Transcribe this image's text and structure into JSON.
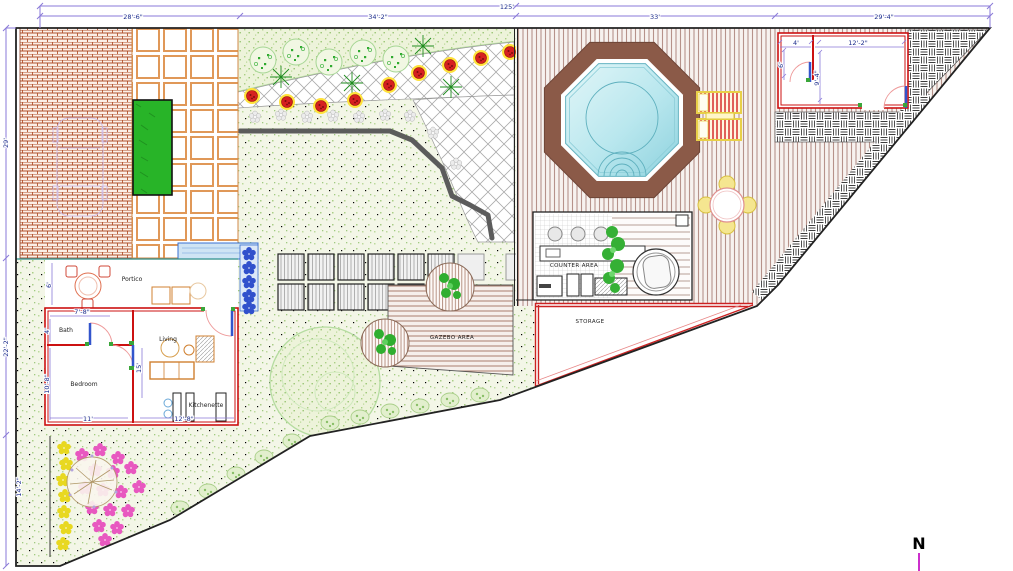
{
  "meta": {
    "north_label": "N"
  },
  "dimensions": {
    "top_total": "125'",
    "top_segments": [
      "28'-6\"",
      "34'-2\"",
      "33'",
      "29'-4\""
    ],
    "left_segments": [
      "29'",
      "22'-2\"",
      "14'-2\""
    ],
    "pool_house": {
      "left_width": "4'",
      "main_width": "12'-2\"",
      "left_depth": "6'",
      "main_depth": "9'-4\""
    },
    "house": {
      "bath_width": "7'-8\"",
      "bath_depth": "4'",
      "portico_depth": "6'",
      "bedroom_depth": "10'-8\"",
      "bedroom_width": "11'",
      "kitchen_width": "12'-8\"",
      "living_depth": "15'"
    }
  },
  "labels": {
    "portico": "Portico",
    "bath": "Bath",
    "bedroom": "Bedroom",
    "living": "Living",
    "kitchenette": "Kitchenette",
    "counter_area": "COUNTER AREA",
    "storage": "STORAGE",
    "gazebo_area": "GAZEBO AREA"
  },
  "colors": {
    "dimension_line": "#8a7ad8",
    "dimension_text": "#1b2c8c",
    "wall_red": "#cc1111",
    "pool_border": "#8b5a48",
    "pool_water": "#aee0ea",
    "north_arrow": "#cc30cc",
    "hedge_green": "#28b428",
    "brick": "#b35430",
    "paver_orange": "#e09858"
  }
}
